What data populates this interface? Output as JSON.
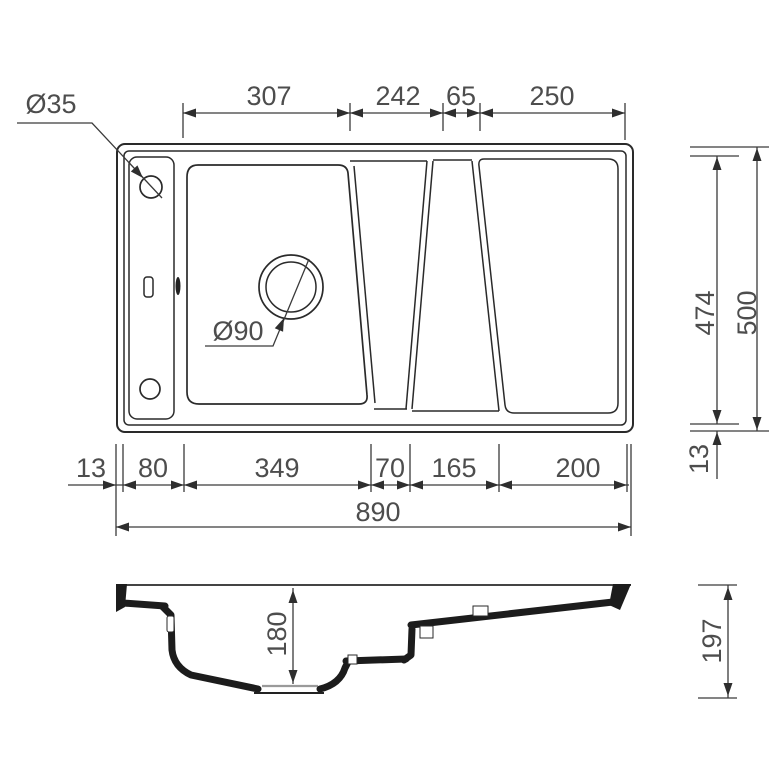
{
  "plan": {
    "hole_label": "Ø35",
    "drain_label": "Ø90",
    "top_dims": [
      "307",
      "242",
      "65",
      "250"
    ],
    "bottom_dims": [
      "13",
      "80",
      "349",
      "70",
      "165",
      "200"
    ],
    "overall_width": "890",
    "right_dims": {
      "inner_depth": "474",
      "outer_depth": "500",
      "rim": "13"
    }
  },
  "section": {
    "bowl_depth": "180",
    "overall_height": "197"
  },
  "colors": {
    "line": "#2a2a2a",
    "text": "#4d4d4d",
    "background": "#ffffff"
  }
}
